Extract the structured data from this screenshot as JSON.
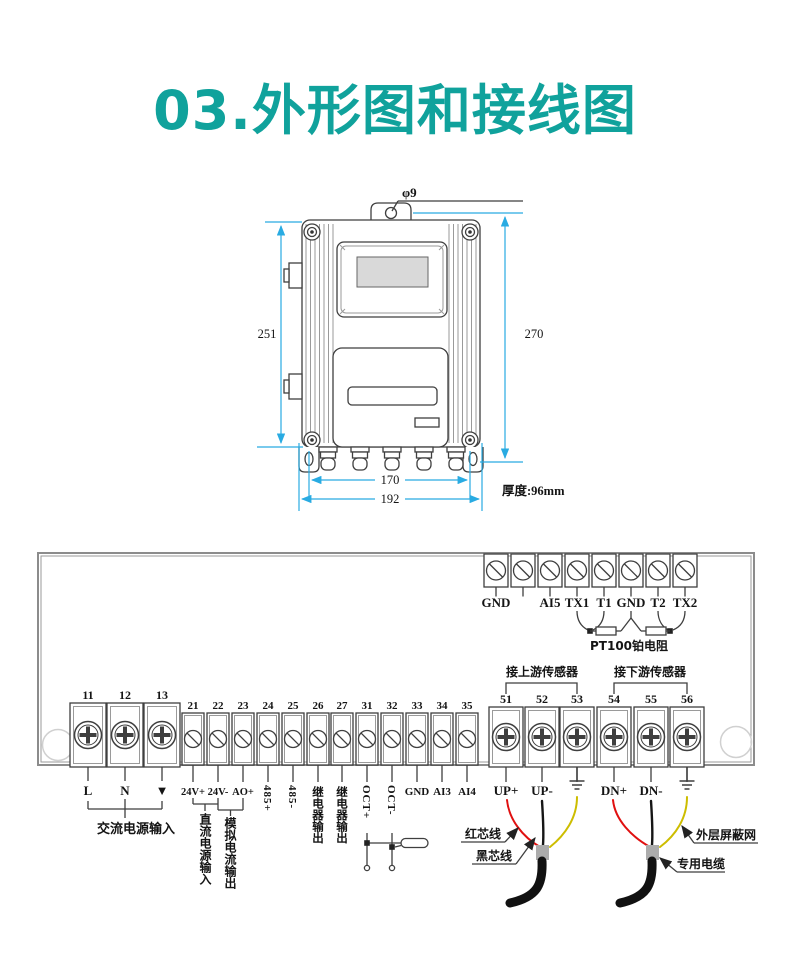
{
  "title": "03.外形图和接线图",
  "colors": {
    "title_accent": "#10a29c",
    "dimension_line": "#29abe2",
    "red_wire": "#e01010",
    "yellow_wire": "#cdbd00"
  },
  "outline": {
    "hole_diameter": "φ9",
    "body_height": "251",
    "overall_height": "270",
    "gland_span": "170",
    "overall_width": "192",
    "thickness": "厚度:96mm"
  },
  "wiring": {
    "top_block": {
      "labels": [
        "GND",
        "",
        "AI5",
        "TX1",
        "T1",
        "GND",
        "T2",
        "TX2"
      ],
      "pt100": "PT100铂电阻"
    },
    "power": {
      "numbers": [
        "11",
        "12",
        "13"
      ],
      "labels": [
        "L",
        "N",
        "▼"
      ],
      "caption": "交流电源输入"
    },
    "mid": {
      "numbers": [
        "21",
        "22",
        "23",
        "24",
        "25",
        "26",
        "27",
        "31",
        "32",
        "33",
        "34",
        "35"
      ],
      "label_24vp": "24V+",
      "label_24vm": "24V-",
      "label_aop": "AO+",
      "label_485p": "485+",
      "label_485m": "485-",
      "label_relay1": "继电器输出",
      "label_relay2": "继电器输出",
      "label_octp": "OCT+",
      "label_octm": "OCT-",
      "label_gnd": "GND",
      "label_ai3": "AI3",
      "label_ai4": "AI4",
      "dc_caption": "直流电源输入",
      "ao_caption": "模拟电流输出"
    },
    "sensor": {
      "numbers": [
        "51",
        "52",
        "53",
        "54",
        "55",
        "56"
      ],
      "label_upp": "UP+",
      "label_upm": "UP-",
      "label_dnp": "DN+",
      "label_dnm": "DN-",
      "upstream": "接上游传感器",
      "downstream": "接下游传感器"
    },
    "annotations": {
      "red_core": "红芯线",
      "black_core": "黑芯线",
      "shield": "外层屏蔽网",
      "cable": "专用电缆"
    }
  }
}
